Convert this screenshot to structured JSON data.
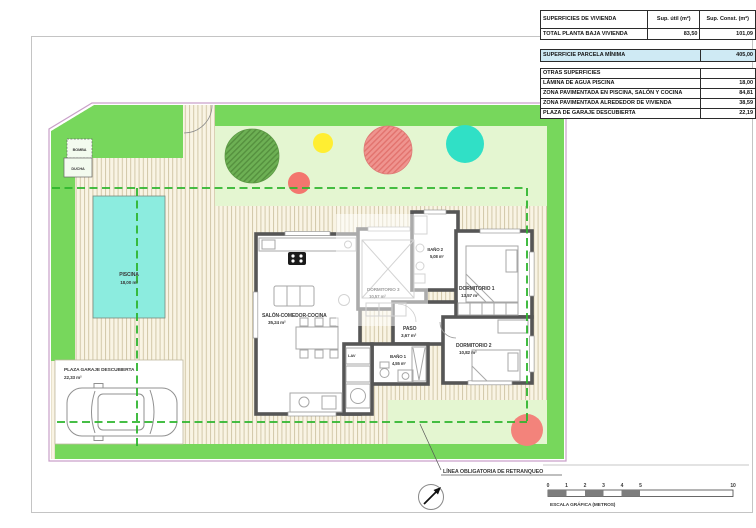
{
  "tables": {
    "vivienda": {
      "title": "SUPERFICIES DE VIVIENDA",
      "col_util": "Sup. útil (m²)",
      "col_const": "Sup. Const. (m²)",
      "row_label": "TOTAL PLANTA BAJA VIVIENDA",
      "row_util": "83,50",
      "row_const": "101,09"
    },
    "parcela": {
      "label": "SUPERFICIE PARCELA MÍNIMA",
      "value": "405,00"
    },
    "otras": {
      "title": "OTRAS SUPERFICIES",
      "rows": [
        {
          "label": "LÁMINA DE AGUA PISCINA",
          "value": "18,00"
        },
        {
          "label": "ZONA PAVIMENTADA EN PISCINA, SALÓN Y COCINA",
          "value": "84,81"
        },
        {
          "label": "ZONA PAVIMENTADA ALREDEDOR DE VIVIENDA",
          "value": "38,59"
        },
        {
          "label": "PLAZA DE GARAJE DESCUBIERTA",
          "value": "22,19"
        }
      ]
    }
  },
  "plan": {
    "rooms": {
      "salon": {
        "name": "SALÓN-COMEDOR-COCINA",
        "area": "35,24 m²"
      },
      "dorm3": {
        "name": "DORMITORIO 3",
        "area": "10,57 m²"
      },
      "dorm1": {
        "name": "DORMITORIO 1",
        "area": "13,57 m²"
      },
      "dorm2": {
        "name": "DORMITORIO 2",
        "area": "10,82 m²"
      },
      "bano1": {
        "name": "BAÑO 1",
        "area": "4,55 m²"
      },
      "bano2": {
        "name": "BAÑO 2",
        "area": "5,08 m²"
      },
      "paso": {
        "name": "PASO",
        "area": "3,67 m²"
      },
      "lav": {
        "name": "LAV"
      }
    },
    "piscina": {
      "name": "PISCINA",
      "area": "18,00 m²"
    },
    "garaje": {
      "name": "PLAZA GARAJE DESCUBIERTA",
      "area": "22,33 m²"
    },
    "bomba": "BOMBA",
    "ducha": "DUCHA",
    "retranqueo": "LÍNEA OBLIGATORIA DE RETRANQUEO"
  },
  "scale_bar": {
    "ticks": [
      "0",
      "1",
      "2",
      "3",
      "4",
      "5",
      "10"
    ],
    "caption": "ESCALA GRÁFICA (METROS)"
  },
  "colors": {
    "grass_dark": "#77d75c",
    "grass_light": "#e4f6d1",
    "pool": "#8cecdf",
    "tree_green": "#6db054",
    "tree_teal": "#30e0c6",
    "tree_yellow": "#ffee32",
    "tree_red": "#f3766e",
    "tree_salmon": "#ef8f8a",
    "retranqueo_line": "#2db52d",
    "parcela_highlight": "#cfeaf4",
    "wall": "#565656"
  }
}
